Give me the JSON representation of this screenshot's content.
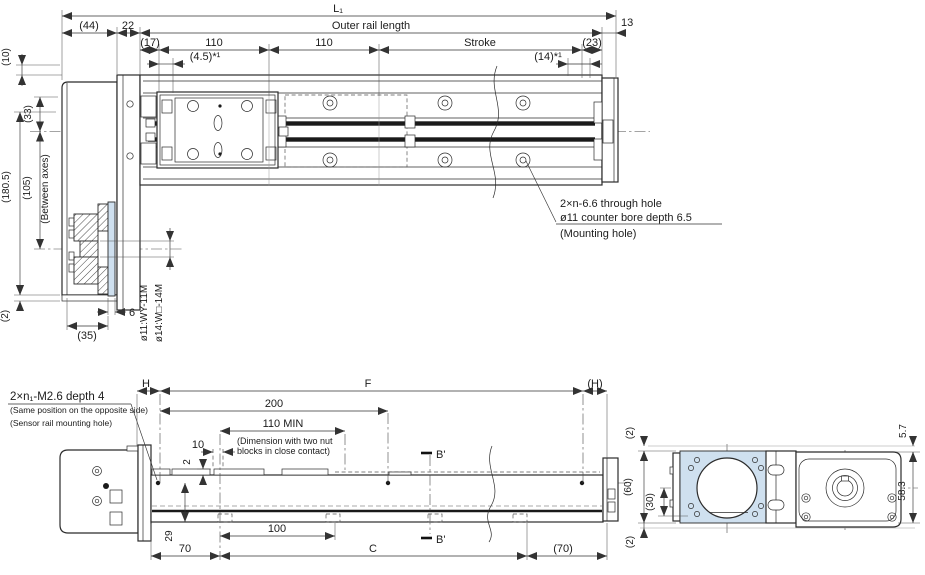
{
  "title": "Linear actuator dimensional drawing",
  "colors": {
    "line": "#2b2b2b",
    "accent_fill": "#cfe0ef",
    "background": "#ffffff",
    "band": "#1a1a1a"
  },
  "top": {
    "l1": "L₁",
    "outer": "Outer rail length",
    "d44": "(44)",
    "d22": "22",
    "d13": "13",
    "d17": "(17)",
    "p110a": "110",
    "p110b": "110",
    "stroke": "Stroke",
    "d23": "(23)",
    "d45": "(4.5)*¹",
    "d14": "(14)*¹",
    "d10": "(10)",
    "d33": "(33)",
    "d105": "(105)",
    "between": "(Between axes)",
    "d1805": "(180.5)",
    "d2": "(2)",
    "d35": "(35)",
    "d6": "6",
    "shaft1": "ø11:WY-11M",
    "shaft2": "ø14:W□-14M",
    "note1": "2×n-6.6 through hole",
    "note2": "ø11 counter bore depth 6.5",
    "note3": "(Mounting hole)"
  },
  "side": {
    "sensor1": "2×n₁-M2.6 depth 4",
    "sensor2": "(Same position on the opposite side)",
    "sensor3": "(Sensor rail mounting hole)",
    "h": "H",
    "f": "F",
    "hp": "(H)",
    "d200": "200",
    "d110min": "110 MIN",
    "nut1": "(Dimension with two nut",
    "nut2": "blocks in close contact)",
    "d10": "10",
    "d2": "2",
    "d29": "29",
    "d70": "70",
    "d100": "100",
    "c": "C",
    "d70p": "(70)",
    "bprime_top": "B'",
    "bprime_bottom": "B'"
  },
  "end": {
    "d2top": "(2)",
    "d60": "(60)",
    "d30": "(30)",
    "d2bot": "(2)",
    "d57": "5.7",
    "d583": "58.3"
  }
}
